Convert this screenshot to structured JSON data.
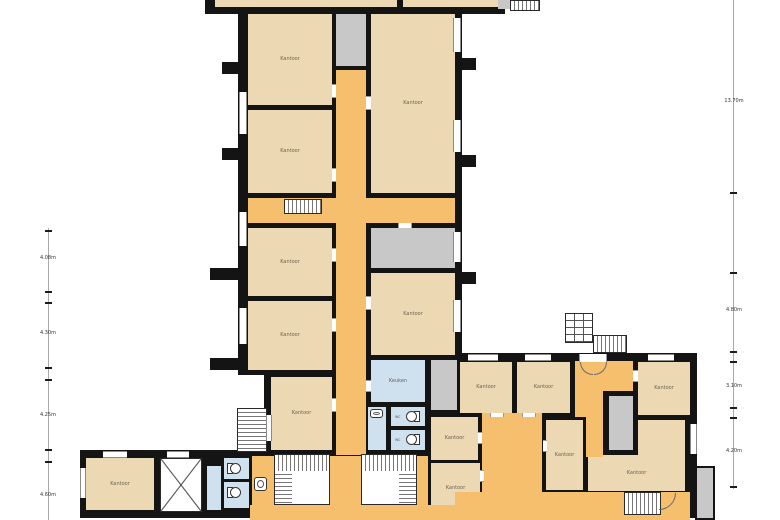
{
  "rooms": [
    {
      "name": "tower-office-1",
      "label": "Kantoor"
    },
    {
      "name": "tower-office-2",
      "label": "Kantoor"
    },
    {
      "name": "tower-office-3",
      "label": "Kantoor"
    },
    {
      "name": "tower-office-4",
      "label": "Kantoor"
    },
    {
      "name": "tower-office-5",
      "label": "Kantoor"
    },
    {
      "name": "tower-office-6",
      "label": "Kantoor"
    },
    {
      "name": "tower-office-7",
      "label": "Kantoor"
    },
    {
      "name": "kitchen",
      "label": "Keuken"
    },
    {
      "name": "wc-1",
      "label": "wc"
    },
    {
      "name": "wc-2",
      "label": "wc"
    },
    {
      "name": "west-office",
      "label": "Kantoor"
    },
    {
      "name": "east-office-1",
      "label": "Kantoor"
    },
    {
      "name": "east-office-2",
      "label": "Kantoor"
    },
    {
      "name": "east-office-3",
      "label": "Kantoor"
    },
    {
      "name": "east-office-4",
      "label": "Kantoor"
    },
    {
      "name": "east-office-5",
      "label": "Kantoor"
    },
    {
      "name": "east-office-6",
      "label": "Kantoor"
    },
    {
      "name": "east-office-7",
      "label": "Kantoor"
    }
  ],
  "dimensions": {
    "left": [
      "4.08m",
      "4.30m",
      "4.25m",
      "4.60m"
    ],
    "right": [
      "13.70m",
      "4.80m",
      "3.10m",
      "4.20m"
    ]
  },
  "features": {
    "stairs": "staircase",
    "elevator": "elevator",
    "toilet": "toilet",
    "washbasin": "washbasin"
  },
  "colors": {
    "wall": "#141414",
    "office": "#ecd9b3",
    "corridor": "#f5bf6e",
    "shaft": "#c8c8c8",
    "wet": "#cfe1ee"
  }
}
